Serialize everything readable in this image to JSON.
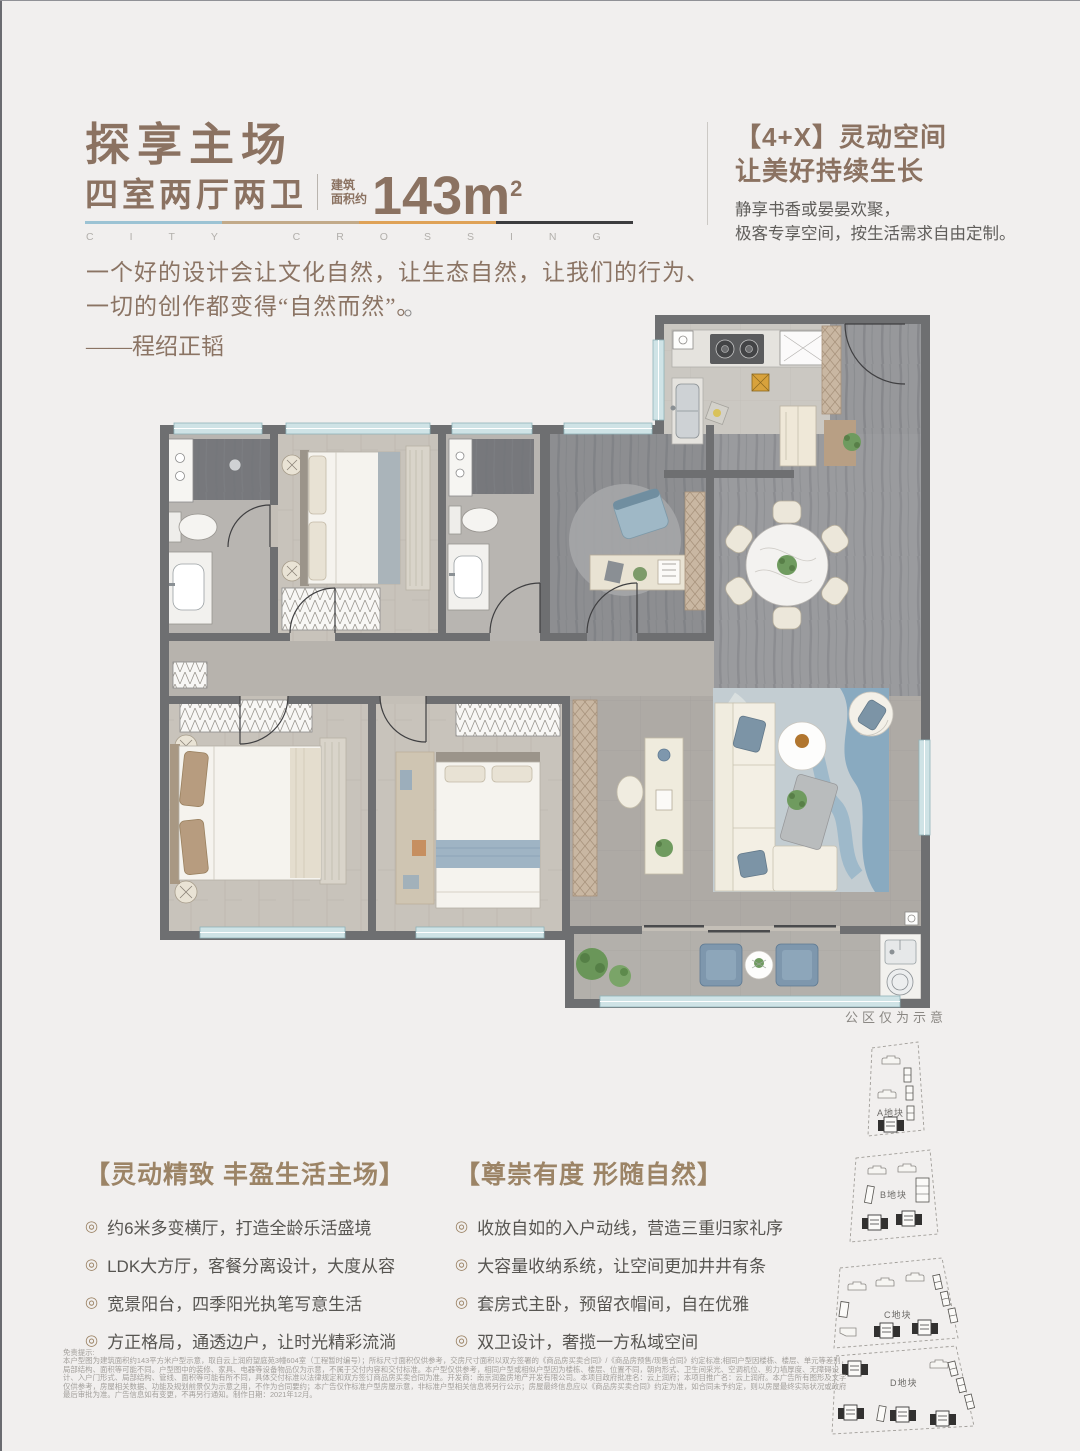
{
  "ui": {
    "bullet": "◎"
  },
  "colors": {
    "accent_brown": "#8b7261",
    "feature_gold": "#9c8466",
    "divider_segments": [
      "#9cc3d4",
      "#c2aa89",
      "#dfa257",
      "#3c3c3e"
    ],
    "wall_gray": "#6e6f71",
    "window_teal": "#cfe3e6"
  },
  "header": {
    "title": "探享主场",
    "subtitle": "四室两厅两卫",
    "area_label_line1": "建筑",
    "area_label_line2": "面积约",
    "area_value": "143",
    "area_unit": "m",
    "area_sup": "2",
    "watermark": "CITY CROSSING"
  },
  "quote": {
    "line1": "一个好的设计会让文化自然，让生态自然，让我们的行为、",
    "line2": "一切的创作都变得“自然而然”。",
    "author": "——程绍正韬"
  },
  "right_panel": {
    "title_line1": "【4+X】灵动空间",
    "title_line2": "让美好持续生长",
    "body_line1": "静享书香或晏晏欢聚，",
    "body_line2": "极客专享空间，按生活需求自由定制。"
  },
  "floorplan": {
    "note": "公区仅为示意"
  },
  "features_left": {
    "title": "【灵动精致 丰盈生活主场】",
    "items": [
      "约6米多变横厅，打造全龄乐活盛境",
      "LDK大方厅，客餐分离设计，大度从容",
      "宽景阳台，四季阳光执笔写意生活",
      "方正格局，通透边户，让时光精彩流淌"
    ]
  },
  "features_right": {
    "title": "【尊崇有度 形随自然】",
    "items": [
      "收放自如的入户动线，营造三重归家礼序",
      "大容量收纳系统，让空间更加井井有条",
      "套房式主卧，预留衣帽间，自在优雅",
      "双卫设计，奢揽一方私域空间"
    ]
  },
  "siteplan": {
    "blocks": [
      {
        "label": "A地块"
      },
      {
        "label": "B地块"
      },
      {
        "label": "C地块"
      },
      {
        "label": "D地块"
      }
    ]
  },
  "disclaimer": {
    "title": "免责提示:",
    "lines": [
      "本户型图为建筑面积约143平方米户型示意，取自云上润府望庭苑3幢604室（工程暂时编号）；所标尺寸面积仅供参考，交房尺寸面积以双方签署的《商品房买卖合同》/《商品房预售/现售合同》约定标准;相同户型因楼栋、楼层、单元等差别，",
      "局部结构、面积等可能不同。户型图中的装修、家具、电器等设备物品仅为示意，不属于交付内容和交付标准。本户型仅供参考，相同户型或相似户型因为楼栋、楼层、位置不同，朝向形式、卫生间采光、空调机位、剪力墙厚度、无障碍设",
      "计、入户门形式、局部结构、管线、面积等可能有所不同，具体交付标准以法律规定和双方签订商品房买卖合同为准。开发商：南京润盈房地产开发有限公司。本项目政府批准名：云上润府；本项目推广名：云上润府。本广告所有图形及文字",
      "仅供参考，房屋相关数据、功能及规划前景仅为示意之用，不作为合同要约；本广告仅作标准户型房屋示意，非标准户型相关信息将另行公示；房屋最终信息应以《商品房买卖合同》约定为准，如合同未予约定，则以房屋最终实际状况或政府",
      "最后审批为准。广告信息如有变更，不再另行通知。制作日期：2021年12月。"
    ]
  }
}
